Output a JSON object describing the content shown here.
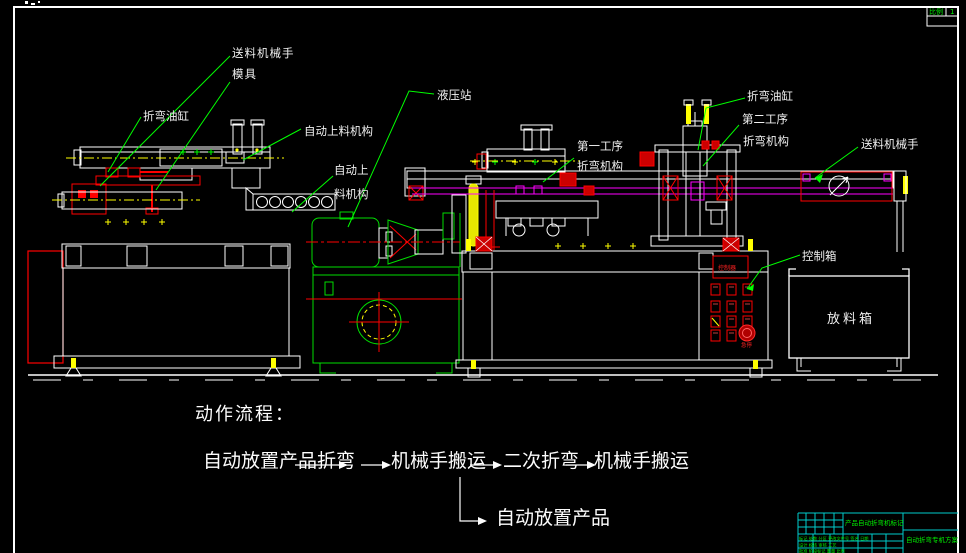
{
  "canvas": {
    "background": "#000000",
    "frame_color": "#ffffff"
  },
  "colors": {
    "leader_green": "#00ff00",
    "machine_green": "#00dd00",
    "cad_red": "#ff0000",
    "cad_yellow": "#ffff00",
    "cad_magenta": "#ff00ff",
    "cad_white": "#ffffff",
    "grid_cyan": "#00cccc",
    "label_white": "#f0f0f0"
  },
  "labels": {
    "feed_manipulator_left": "送料机械手",
    "mold": "模具",
    "bend_cylinder_left": "折弯油缸",
    "auto_feed_upper": "自动上料机构",
    "hydraulic_station": "液压站",
    "auto_feed_lower_1": "自动上",
    "auto_feed_lower_2": "料机构",
    "process1_line1": "第一工序",
    "process1_line2": "折弯机构",
    "bend_cylinder_right": "折弯油缸",
    "process2_line1": "第二工序",
    "process2_line2": "折弯机构",
    "feed_manipulator_right": "送料机械手",
    "control_box": "控制箱",
    "discharge_box": "放料箱"
  },
  "flow": {
    "title": "动作流程：",
    "step1": "自动放置产品",
    "step2": "折弯",
    "step3": "机械手搬运",
    "step4": "二次折弯",
    "step5": "机械手搬运",
    "branch": "自动放置产品"
  },
  "control_panel": {
    "screen_label": "控制器",
    "estop_label": "急停"
  },
  "title_block": {
    "part_label": "产品自动折弯机标记",
    "scheme_name": "自动折弯专机方案",
    "row1": "标记 处数 分区 更改文件号 签名 日期",
    "row2": "设计 校核 审核 工艺",
    "row3": "批准 阶段标记 重量 比例",
    "corner_label": "比例",
    "corner_value": "1"
  }
}
